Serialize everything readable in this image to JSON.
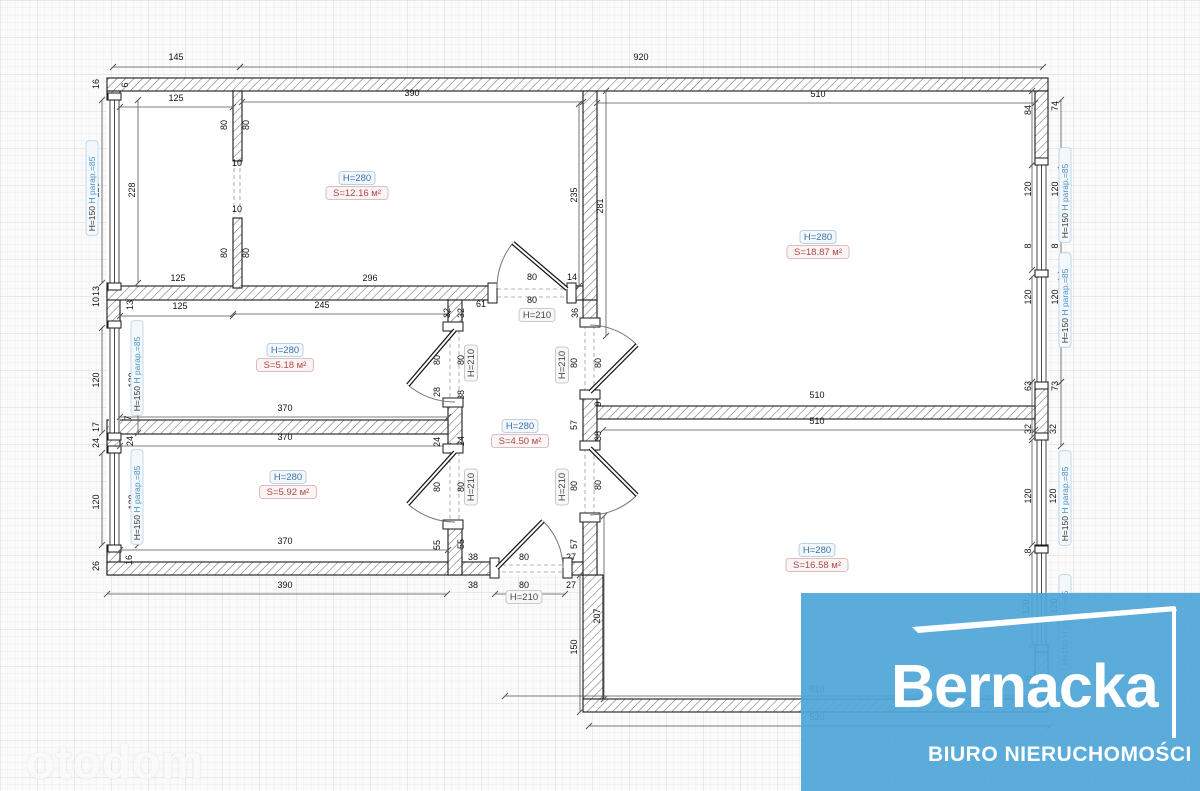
{
  "watermark": {
    "text": "otodom"
  },
  "logo": {
    "title": "Bernacka",
    "subtitle": "BIURO NIERUCHOMOŚCI",
    "bg_color": "#4fa5d8",
    "accent_color": "#ffffff"
  },
  "colors": {
    "wall_stroke": "#1a1a1a",
    "hatch": "#6f6f6f",
    "dim_line": "#555555",
    "dim_text": "#111111",
    "arc": "#777777",
    "dash": "#9a9a9a",
    "h_label_text": "#3f72ad",
    "h_label_border": "#a9c4de",
    "h_label_bg": "#f2f7fb",
    "s_label_text": "#ad4848",
    "s_label_border": "#d6aaaa",
    "s_label_bg": "#fbf4f4",
    "door_label_text": "#4a4a4a",
    "door_label_border": "#bcbcbc",
    "door_label_bg": "#f7f7f7",
    "win_label_text1": "#333333",
    "win_label_text2": "#4a90c8",
    "win_label_border": "#b8d2e6",
    "win_label_bg": "#f3f8fc"
  },
  "plan": {
    "white_areas": [
      [
        107,
        78,
        941,
        497
      ],
      [
        583,
        575,
        465,
        137
      ]
    ],
    "walls": [
      [
        107,
        78,
        941,
        13
      ],
      [
        107,
        91,
        13,
        9
      ],
      [
        107,
        283,
        13,
        45
      ],
      [
        107,
        433,
        13,
        20
      ],
      [
        107,
        545,
        13,
        30
      ],
      [
        107,
        562,
        390,
        13
      ],
      [
        565,
        562,
        32,
        13
      ],
      [
        583,
        575,
        20,
        124
      ],
      [
        583,
        699,
        465,
        13
      ],
      [
        1035,
        91,
        13,
        74
      ],
      [
        1035,
        270,
        13,
        7
      ],
      [
        1035,
        382,
        13,
        58
      ],
      [
        1035,
        545,
        13,
        8
      ],
      [
        1035,
        645,
        13,
        54
      ],
      [
        107,
        286,
        390,
        14
      ],
      [
        567,
        286,
        30,
        14
      ],
      [
        583,
        91,
        14,
        209
      ],
      [
        583,
        300,
        14,
        25
      ],
      [
        583,
        392,
        14,
        56
      ],
      [
        583,
        515,
        14,
        60
      ],
      [
        597,
        406,
        438,
        13
      ],
      [
        448,
        300,
        14,
        30
      ],
      [
        448,
        400,
        14,
        52
      ],
      [
        448,
        522,
        14,
        53
      ],
      [
        107,
        420,
        341,
        14
      ],
      [
        233,
        91,
        9,
        70
      ],
      [
        233,
        218,
        9,
        70
      ]
    ],
    "windows": [
      {
        "x": 110,
        "y": 100,
        "len": 183
      },
      {
        "x": 110,
        "y": 328,
        "len": 105
      },
      {
        "x": 110,
        "y": 453,
        "len": 92
      },
      {
        "x": 1037,
        "y": 165,
        "len": 105
      },
      {
        "x": 1037,
        "y": 277,
        "len": 105
      },
      {
        "x": 1037,
        "y": 440,
        "len": 105
      },
      {
        "x": 1037,
        "y": 553,
        "len": 92
      }
    ],
    "dashes": [
      [
        497,
        289,
        567,
        289
      ],
      [
        497,
        297,
        567,
        297
      ],
      [
        450,
        330,
        450,
        400
      ],
      [
        459,
        330,
        459,
        400
      ],
      [
        450,
        452,
        450,
        522
      ],
      [
        459,
        452,
        459,
        522
      ],
      [
        585,
        325,
        585,
        392
      ],
      [
        594,
        325,
        594,
        392
      ],
      [
        585,
        448,
        585,
        515
      ],
      [
        594,
        448,
        594,
        515
      ],
      [
        495,
        565,
        565,
        565
      ],
      [
        495,
        572,
        565,
        572
      ],
      [
        234,
        161,
        234,
        218
      ],
      [
        240,
        161,
        240,
        218
      ]
    ],
    "doors": [
      {
        "jambs": [
          [
            488,
            283,
            9,
            20
          ],
          [
            567,
            283,
            9,
            20
          ]
        ],
        "leaf": [
          567,
          289,
          513,
          243
        ],
        "arc": "M497,288 A70,70 0 0 1 513,243"
      },
      {
        "jambs": [
          [
            443,
            322,
            20,
            9
          ],
          [
            443,
            398,
            20,
            9
          ]
        ],
        "leaf": [
          455,
          330,
          408,
          385
        ],
        "arc": "M408,385 A72,72 0 0 0 455,402"
      },
      {
        "jambs": [
          [
            443,
            444,
            20,
            9
          ],
          [
            443,
            520,
            20,
            9
          ]
        ],
        "leaf": [
          455,
          452,
          408,
          504
        ],
        "arc": "M408,504 A70,70 0 0 0 455,522"
      },
      {
        "jambs": [
          [
            580,
            318,
            20,
            9
          ],
          [
            580,
            390,
            20,
            9
          ]
        ],
        "leaf": [
          590,
          392,
          637,
          345
        ],
        "arc": "M637,345 A67,67 0 0 0 590,325"
      },
      {
        "jambs": [
          [
            580,
            441,
            20,
            9
          ],
          [
            580,
            513,
            20,
            9
          ]
        ],
        "leaf": [
          590,
          448,
          637,
          495
        ],
        "arc": "M637,495 A67,67 0 0 1 590,515"
      },
      {
        "jambs": [
          [
            490,
            558,
            9,
            20
          ],
          [
            563,
            558,
            9,
            20
          ]
        ],
        "leaf": [
          497,
          568,
          543,
          521
        ],
        "arc": "M543,521 A66,66 0 0 1 563,568"
      }
    ],
    "dims": [
      {
        "t": "145",
        "x": 176,
        "y": 60,
        "r": 0,
        "l": [
          113,
          67,
          240,
          67
        ]
      },
      {
        "t": "920",
        "x": 641,
        "y": 60,
        "r": 0,
        "l": [
          240,
          67,
          1043,
          67
        ]
      },
      {
        "t": "125",
        "x": 176,
        "y": 101,
        "r": 0,
        "l": [
          120,
          107,
          233,
          107
        ]
      },
      {
        "t": "390",
        "x": 412,
        "y": 96,
        "r": 0,
        "l": [
          242,
          102,
          583,
          102
        ]
      },
      {
        "t": "10",
        "x": 237,
        "y": 166,
        "r": 0
      },
      {
        "t": "10",
        "x": 237,
        "y": 212,
        "r": 0
      },
      {
        "t": "125",
        "x": 178,
        "y": 281,
        "r": 0
      },
      {
        "t": "296",
        "x": 370,
        "y": 281,
        "r": 0
      },
      {
        "t": "510",
        "x": 818,
        "y": 97,
        "r": 0,
        "l": [
          597,
          103,
          1035,
          103
        ]
      },
      {
        "t": "125",
        "x": 180,
        "y": 309,
        "r": 0,
        "l": [
          120,
          316,
          233,
          316
        ]
      },
      {
        "t": "245",
        "x": 322,
        "y": 308,
        "r": 0,
        "l": [
          233,
          314,
          448,
          314
        ]
      },
      {
        "t": "61",
        "x": 481,
        "y": 307,
        "r": 0
      },
      {
        "t": "80",
        "x": 532,
        "y": 280,
        "r": 0
      },
      {
        "t": "14",
        "x": 572,
        "y": 280,
        "r": 0
      },
      {
        "t": "80",
        "x": 532,
        "y": 303,
        "r": 0
      },
      {
        "t": "14",
        "x": 572,
        "y": 303,
        "r": 0
      },
      {
        "t": "370",
        "x": 285,
        "y": 411,
        "r": 0,
        "l": [
          120,
          417,
          448,
          417
        ]
      },
      {
        "t": "370",
        "x": 285,
        "y": 440,
        "r": 0,
        "l": [
          120,
          446,
          448,
          446
        ]
      },
      {
        "t": "370",
        "x": 285,
        "y": 544,
        "r": 0,
        "l": [
          120,
          550,
          448,
          550
        ]
      },
      {
        "t": "390",
        "x": 285,
        "y": 588,
        "r": 0,
        "l": [
          107,
          594,
          447,
          594
        ]
      },
      {
        "t": "38",
        "x": 473,
        "y": 560,
        "r": 0
      },
      {
        "t": "80",
        "x": 524,
        "y": 560,
        "r": 0
      },
      {
        "t": "27",
        "x": 571,
        "y": 560,
        "r": 0
      },
      {
        "t": "38",
        "x": 473,
        "y": 588,
        "r": 0
      },
      {
        "t": "80",
        "x": 524,
        "y": 588,
        "r": 0,
        "l": [
          495,
          594,
          565,
          594
        ]
      },
      {
        "t": "27",
        "x": 571,
        "y": 588,
        "r": 0
      },
      {
        "t": "510",
        "x": 817,
        "y": 398,
        "r": 0
      },
      {
        "t": "510",
        "x": 817,
        "y": 424,
        "r": 0,
        "l": [
          603,
          430,
          1035,
          430
        ]
      },
      {
        "t": "610",
        "x": 817,
        "y": 692,
        "r": 0,
        "l": [
          505,
          696,
          1037,
          696
        ]
      },
      {
        "t": "530",
        "x": 817,
        "y": 720,
        "r": 0,
        "l": [
          589,
          726,
          1050,
          726
        ]
      },
      {
        "t": "16",
        "x": 99,
        "y": 84,
        "r": 1
      },
      {
        "t": "6",
        "x": 128,
        "y": 85,
        "r": 1
      },
      {
        "t": "228",
        "x": 99,
        "y": 190,
        "r": 1,
        "l": [
          102,
          100,
          102,
          283
        ]
      },
      {
        "t": "228",
        "x": 135,
        "y": 190,
        "r": 1,
        "l": [
          138,
          100,
          138,
          283
        ]
      },
      {
        "t": "80",
        "x": 227,
        "y": 125,
        "r": 1
      },
      {
        "t": "80",
        "x": 249,
        "y": 125,
        "r": 1
      },
      {
        "t": "80",
        "x": 227,
        "y": 253,
        "r": 1
      },
      {
        "t": "80",
        "x": 249,
        "y": 253,
        "r": 1
      },
      {
        "t": "235",
        "x": 577,
        "y": 195,
        "r": 1,
        "l": [
          579,
          104,
          579,
          286
        ]
      },
      {
        "t": "281",
        "x": 603,
        "y": 206,
        "r": 1,
        "l": [
          606,
          91,
          606,
          336
        ]
      },
      {
        "t": "84",
        "x": 1031,
        "y": 110,
        "r": 1,
        "l": [
          1032,
          91,
          1032,
          165
        ]
      },
      {
        "t": "74",
        "x": 1058,
        "y": 106,
        "r": 1,
        "l": [
          1061,
          100,
          1061,
          165
        ]
      },
      {
        "t": "120",
        "x": 1031,
        "y": 189,
        "r": 1,
        "l": [
          1032,
          165,
          1032,
          270
        ]
      },
      {
        "t": "120",
        "x": 1058,
        "y": 189,
        "r": 1,
        "l": [
          1061,
          165,
          1061,
          270
        ]
      },
      {
        "t": "8",
        "x": 1031,
        "y": 246,
        "r": 1
      },
      {
        "t": "8",
        "x": 1058,
        "y": 246,
        "r": 1
      },
      {
        "t": "120",
        "x": 1031,
        "y": 297,
        "r": 1,
        "l": [
          1032,
          277,
          1032,
          382
        ]
      },
      {
        "t": "120",
        "x": 1058,
        "y": 297,
        "r": 1,
        "l": [
          1061,
          277,
          1061,
          382
        ]
      },
      {
        "t": "63",
        "x": 1031,
        "y": 386,
        "r": 1,
        "l": [
          1032,
          382,
          1032,
          437
        ]
      },
      {
        "t": "73",
        "x": 1058,
        "y": 386,
        "r": 1,
        "l": [
          1061,
          382,
          1061,
          446
        ]
      },
      {
        "t": "13",
        "x": 99,
        "y": 291,
        "r": 1
      },
      {
        "t": "10",
        "x": 99,
        "y": 302,
        "r": 1
      },
      {
        "t": "13",
        "x": 133,
        "y": 305,
        "r": 1
      },
      {
        "t": "32",
        "x": 450,
        "y": 313,
        "r": 1
      },
      {
        "t": "32",
        "x": 464,
        "y": 313,
        "r": 1
      },
      {
        "t": "36",
        "x": 578,
        "y": 313,
        "r": 1
      },
      {
        "t": "120",
        "x": 99,
        "y": 380,
        "r": 1,
        "l": [
          102,
          328,
          102,
          433
        ]
      },
      {
        "t": "120",
        "x": 135,
        "y": 380,
        "r": 1,
        "l": [
          138,
          328,
          138,
          433
        ]
      },
      {
        "t": "80",
        "x": 440,
        "y": 360,
        "r": 1
      },
      {
        "t": "80",
        "x": 464,
        "y": 360,
        "r": 1
      },
      {
        "t": "28",
        "x": 440,
        "y": 392,
        "r": 1
      },
      {
        "t": "38",
        "x": 464,
        "y": 395,
        "r": 1
      },
      {
        "t": "17",
        "x": 99,
        "y": 427,
        "r": 1
      },
      {
        "t": "7",
        "x": 131,
        "y": 418,
        "r": 1
      },
      {
        "t": "24",
        "x": 99,
        "y": 443,
        "r": 1
      },
      {
        "t": "24",
        "x": 133,
        "y": 441,
        "r": 1
      },
      {
        "t": "24",
        "x": 440,
        "y": 442,
        "r": 1
      },
      {
        "t": "24",
        "x": 464,
        "y": 441,
        "r": 1
      },
      {
        "t": "120",
        "x": 99,
        "y": 502,
        "r": 1,
        "l": [
          102,
          453,
          102,
          545
        ]
      },
      {
        "t": "120",
        "x": 135,
        "y": 502,
        "r": 1,
        "l": [
          138,
          453,
          138,
          545
        ]
      },
      {
        "t": "80",
        "x": 440,
        "y": 487,
        "r": 1
      },
      {
        "t": "80",
        "x": 464,
        "y": 487,
        "r": 1
      },
      {
        "t": "55",
        "x": 440,
        "y": 545,
        "r": 1
      },
      {
        "t": "55",
        "x": 464,
        "y": 544,
        "r": 1
      },
      {
        "t": "16",
        "x": 132,
        "y": 560,
        "r": 1
      },
      {
        "t": "26",
        "x": 99,
        "y": 566,
        "r": 1
      },
      {
        "t": "80",
        "x": 577,
        "y": 363,
        "r": 1
      },
      {
        "t": "80",
        "x": 601,
        "y": 363,
        "r": 1
      },
      {
        "t": "9",
        "x": 601,
        "y": 404,
        "r": 1
      },
      {
        "t": "57",
        "x": 577,
        "y": 425,
        "r": 1
      },
      {
        "t": "38",
        "x": 601,
        "y": 436,
        "r": 1
      },
      {
        "t": "80",
        "x": 577,
        "y": 486,
        "r": 1
      },
      {
        "t": "80",
        "x": 601,
        "y": 485,
        "r": 1
      },
      {
        "t": "57",
        "x": 577,
        "y": 544,
        "r": 1
      },
      {
        "t": "207",
        "x": 600,
        "y": 616,
        "r": 1,
        "l": [
          604,
          516,
          604,
          699
        ]
      },
      {
        "t": "150",
        "x": 577,
        "y": 647,
        "r": 1,
        "l": [
          580,
          575,
          580,
          712
        ]
      },
      {
        "t": "32",
        "x": 1031,
        "y": 429,
        "r": 1
      },
      {
        "t": "32",
        "x": 1056,
        "y": 429,
        "r": 1
      },
      {
        "t": "120",
        "x": 1031,
        "y": 496,
        "r": 1,
        "l": [
          1032,
          440,
          1032,
          545
        ]
      },
      {
        "t": "120",
        "x": 1056,
        "y": 496,
        "r": 1
      },
      {
        "t": "8",
        "x": 1031,
        "y": 551,
        "r": 1
      },
      {
        "t": "120",
        "x": 1029,
        "y": 607,
        "r": 1,
        "l": [
          1032,
          553,
          1032,
          645
        ]
      },
      {
        "t": "120",
        "x": 1057,
        "y": 606,
        "r": 1
      },
      {
        "t": "8",
        "x": 1031,
        "y": 678,
        "r": 1
      }
    ],
    "room_labels": [
      {
        "h": "H=280",
        "s": "S=12.16 м²",
        "x": 357,
        "y": 181
      },
      {
        "h": "H=280",
        "s": "S=18.87 м²",
        "x": 818,
        "y": 240
      },
      {
        "h": "H=280",
        "s": "S=5.18 м²",
        "x": 285,
        "y": 353
      },
      {
        "h": "H=280",
        "s": "S=4.50 м²",
        "x": 520,
        "y": 429
      },
      {
        "h": "H=280",
        "s": "S=5.92 м²",
        "x": 288,
        "y": 480
      },
      {
        "h": "H=280",
        "s": "S=16.58 м²",
        "x": 817,
        "y": 553
      }
    ],
    "door_labels": [
      {
        "t": "H=210",
        "x": 537,
        "y": 318,
        "r": 0
      },
      {
        "t": "H=210",
        "x": 524,
        "y": 600,
        "r": 0
      },
      {
        "t": "H=210",
        "x": 474,
        "y": 363,
        "r": 1
      },
      {
        "t": "H=210",
        "x": 565,
        "y": 365,
        "r": 1
      },
      {
        "t": "H=210",
        "x": 474,
        "y": 487,
        "r": 1
      },
      {
        "t": "H=210",
        "x": 565,
        "y": 487,
        "r": 1
      }
    ],
    "window_labels": [
      {
        "t1": "H=150",
        "t2": "H parap.=85",
        "x": 95,
        "y": 188
      },
      {
        "t1": "H=150",
        "t2": "H parap.=85",
        "x": 140,
        "y": 368
      },
      {
        "t1": "H=150",
        "t2": "H parap.=85",
        "x": 140,
        "y": 497
      },
      {
        "t1": "H=150",
        "t2": "H parap.=85",
        "x": 1068,
        "y": 195
      },
      {
        "t1": "H=150",
        "t2": "H parap.=85",
        "x": 1068,
        "y": 300
      },
      {
        "t1": "H=150",
        "t2": "H parap.=85",
        "x": 1068,
        "y": 498
      },
      {
        "t1": "H=150",
        "t2": "H parap.=85",
        "x": 1068,
        "y": 622
      }
    ]
  }
}
